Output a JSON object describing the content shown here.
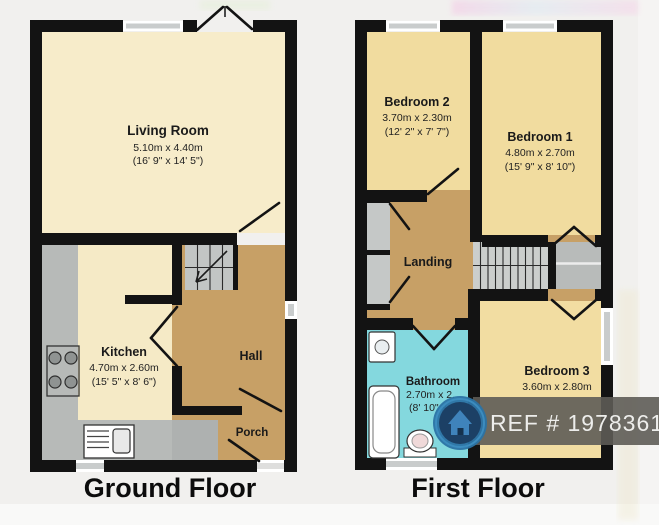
{
  "image_type": "estate-agent floorplan, two storeys side by side",
  "ground": {
    "label": "Ground Floor",
    "living": {
      "name": "Living Room",
      "metric": "5.10m x 4.40m",
      "imperial": "(16' 9\" x 14' 5\")"
    },
    "kitchen": {
      "name": "Kitchen",
      "metric": "4.70m x 2.60m",
      "imperial": "(15' 5\" x 8' 6\")"
    },
    "hall": {
      "name": "Hall"
    },
    "porch": {
      "name": "Porch"
    }
  },
  "first": {
    "label": "First Floor",
    "bedroom2": {
      "name": "Bedroom 2",
      "metric": "3.70m x 2.30m",
      "imperial": "(12' 2\" x 7' 7\")"
    },
    "bedroom1": {
      "name": "Bedroom 1",
      "metric": "4.80m x 2.70m",
      "imperial": "(15' 9\" x 8' 10\")"
    },
    "landing": {
      "name": "Landing"
    },
    "bathroom": {
      "name": "Bathroom",
      "metric_partial": "2.70m x 2.",
      "imperial_partial": "(8' 10\" x"
    },
    "bedroom3": {
      "name": "Bedroom 3",
      "metric": "3.60m x 2.80m"
    }
  },
  "watermark": {
    "ref": "REF # 1978361",
    "logo_icon": "house-logo-icon"
  },
  "colors": {
    "background": "#f1f0ee",
    "wall": "#131313",
    "room_cream": "#f7ecca",
    "room_gold": "#f1dc9f",
    "hall_tan": "#c7a066",
    "bathroom_cyan": "#84d8de",
    "counter_gray": "#b7bab8",
    "window_gray": "#c9cccc",
    "banner_gray": "#5e5c57",
    "banner_text": "#ededeb",
    "logo_ring_blue": "#3c8cbe",
    "logo_navy": "#1c4065",
    "logo_house_blue": "#3f83bb"
  }
}
